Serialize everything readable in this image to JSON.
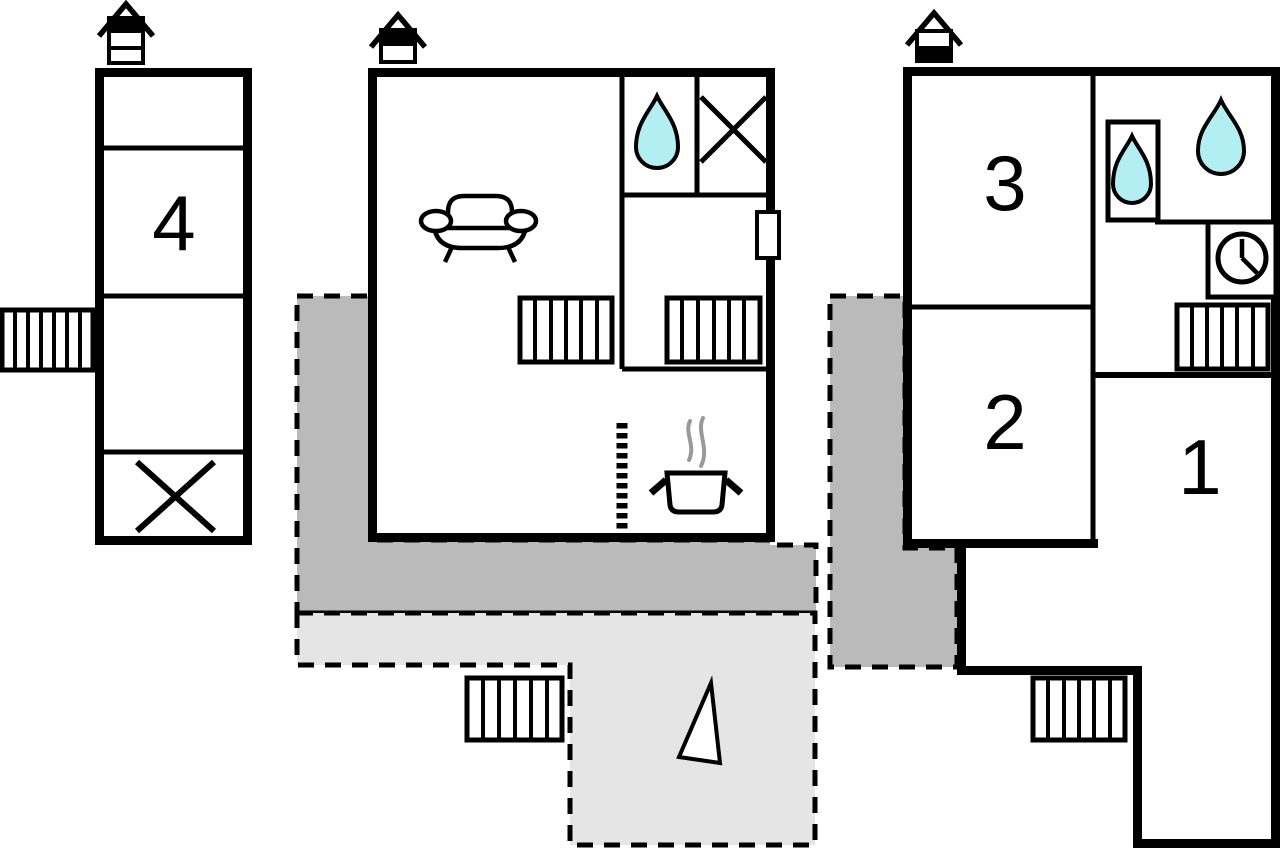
{
  "document": {
    "type": "floor-plan"
  },
  "labels": {
    "room1": "1",
    "room2": "2",
    "room3": "3",
    "room4": "4"
  },
  "colors": {
    "wall": "#000000",
    "terrace-dark": "#bababa",
    "terrace-light": "#e5e5e5",
    "water": "#b3eef2",
    "steam": "#999999"
  },
  "buildings": [
    {
      "id": "annex",
      "rooms": [
        "4"
      ],
      "icons": [
        "chimney-icon",
        "window-icon",
        "crossed-area-icon"
      ]
    },
    {
      "id": "first-floor",
      "rooms": [
        "living-kitchen",
        "bathroom"
      ],
      "icons": [
        "chimney-icon",
        "sofa-icon",
        "water-drop-icon",
        "crossed-area-icon",
        "stairs-icon",
        "stairs-icon",
        "door-icon",
        "stove-pot-icon",
        "kitchen-partition"
      ]
    },
    {
      "id": "ground-floor",
      "rooms": [
        "3",
        "2",
        "1",
        "hall",
        "bathroom"
      ],
      "icons": [
        "chimney-icon",
        "water-drop-icon",
        "water-drop-icon",
        "shower-cubicle-icon",
        "clock-icon",
        "stairs-icon",
        "stairs-icon"
      ]
    }
  ],
  "terraces": [
    {
      "style": "covered"
    },
    {
      "style": "open"
    },
    {
      "style": "covered"
    }
  ],
  "compass": {
    "north_arrow": true
  }
}
